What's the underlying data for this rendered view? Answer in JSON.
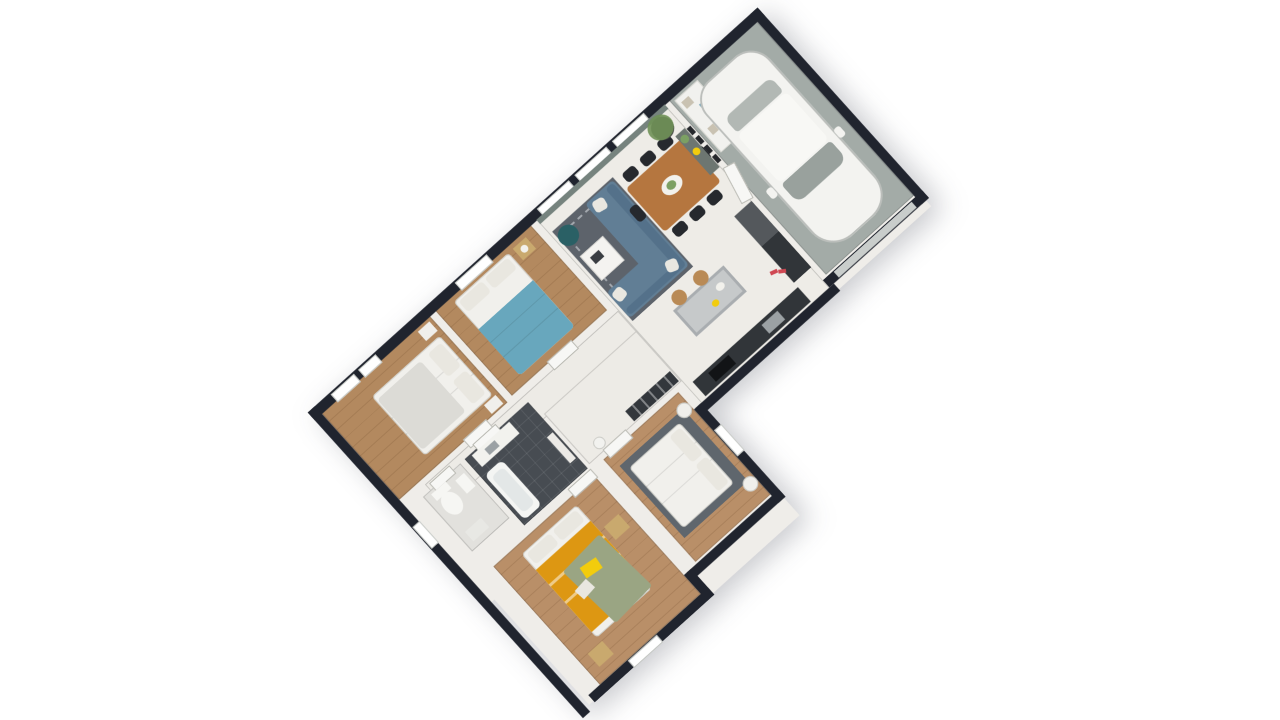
{
  "scene": {
    "type": "3d-floorplan-top-view",
    "rotation_deg": -42,
    "rooms": [
      {
        "id": "living-dining-kitchen"
      },
      {
        "id": "garage"
      },
      {
        "id": "bedroom-1"
      },
      {
        "id": "bedroom-2"
      },
      {
        "id": "bedroom-3-yellow"
      },
      {
        "id": "master-bedroom"
      },
      {
        "id": "bathroom"
      },
      {
        "id": "wc"
      },
      {
        "id": "hallway"
      }
    ]
  },
  "palette": {
    "page_bg": "#ffffff",
    "exterior_wall": "#20242e",
    "interior_wall": "#efede9",
    "cream_floor": "#eeece7",
    "hall_floor": "#edebe6",
    "wood_floor": "#b3895f",
    "wood_floor_light": "#b98f68",
    "garage_floor": "#a3aba7",
    "garage_door": "#c9cdcb",
    "bath_floor": "#474c52",
    "wc_floor": "#e2e1dd",
    "rug_dark": "#5d636b",
    "rug_master": "#5f666d",
    "sofa": "#617e95",
    "sofa_dark": "#54718a",
    "pouf": "#2a6065",
    "coffee_table": "#f4f3f0",
    "book": "#3a3d42",
    "dining_table": "#b5763f",
    "chair": "#26292e",
    "table_decor": "#f2f1ec",
    "decor_green": "#7ca063",
    "island_body": "#a9adb0",
    "island_top": "#c6c9ca",
    "stool_wood": "#b98a55",
    "counter": "#313539",
    "cooktop": "#121416",
    "sink": "#9ba1a4",
    "fridge": "#54585c",
    "console": "#6d7671",
    "frame": "#26282c",
    "plant": "#6f9157",
    "planter": "#4a4e48",
    "sage_wall": "#76837e",
    "window": "#ffffff",
    "door": "#f7f7f5",
    "closet": "#33373c",
    "car_body": "#f3f3f0",
    "car_roof": "#f8f8f5",
    "car_glass_front": "#99a19d",
    "car_glass_rear": "#b2b8b4",
    "shelf": "#f1f1ee",
    "shelf_box_blue": "#7da7b8",
    "shelf_box_tan": "#c9c2b2",
    "bed_white": "#f1f0ec",
    "duvet_gray": "#dcdbd6",
    "pillow": "#e9e7e0",
    "blue_blanket": "#68a7bd",
    "amber_blanket": "#dd9712",
    "green_blanket": "#9aa583",
    "yellow_pillow": "#f2cc0d",
    "nightstand_wood": "#c9a96e",
    "nightstand_white": "#f0efeb",
    "vanity": "#f2f2ee",
    "tub": "#f4f5f3",
    "tub_inner": "#e3e7e7",
    "toilet": "#f6f6f3",
    "bath_mat": "#e8e8e4",
    "towel_shelf": "#eceae6",
    "shoes_red": "#cf4752",
    "roomba": "#f2f2ef"
  }
}
